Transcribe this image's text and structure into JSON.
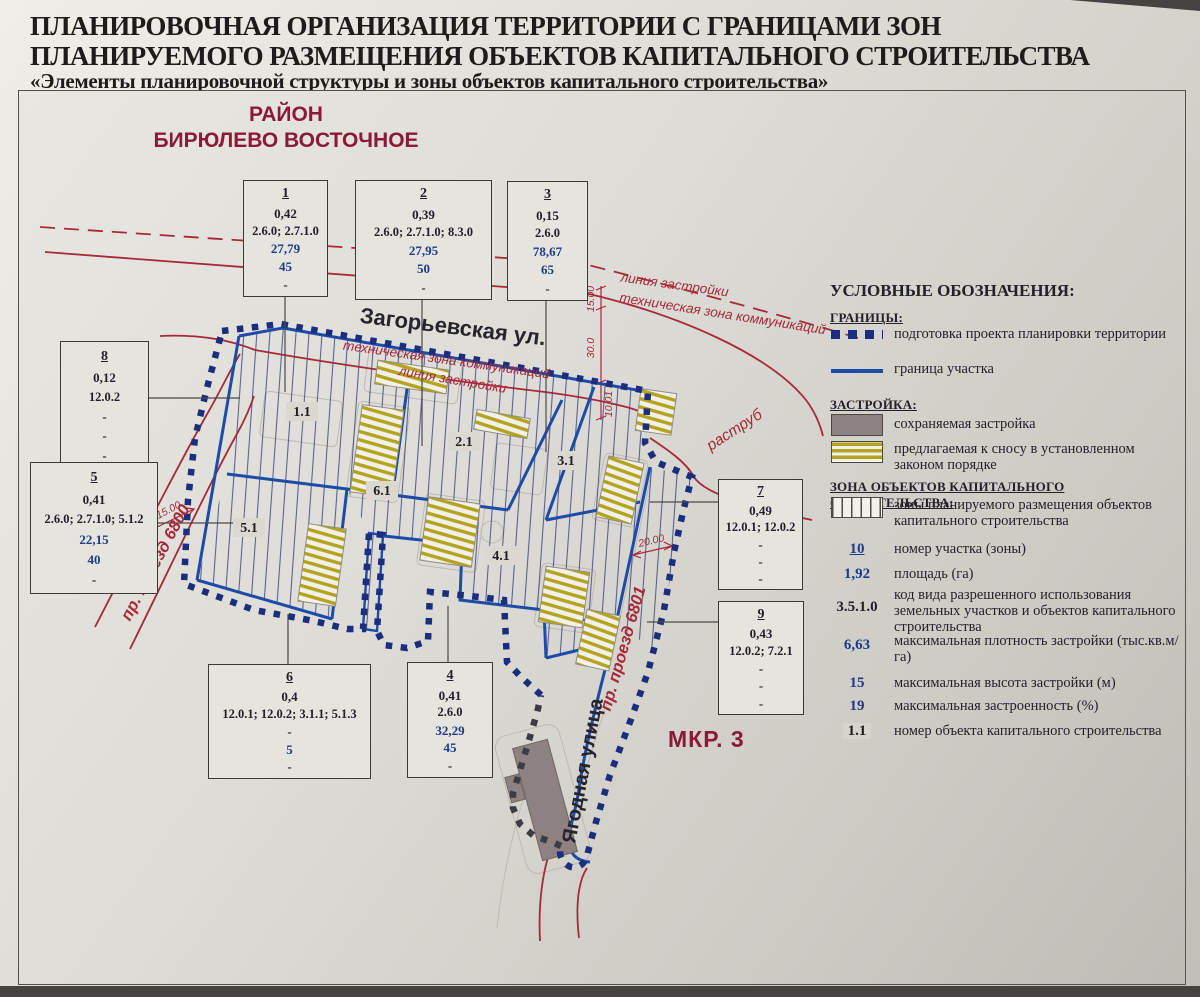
{
  "title": {
    "line1": "ПЛАНИРОВОЧНАЯ ОРГАНИЗАЦИЯ ТЕРРИТОРИИ С ГРАНИЦАМИ ЗОН",
    "line2": "ПЛАНИРУЕМОГО РАЗМЕЩЕНИЯ ОБЪЕКТОВ КАПИТАЛЬНОГО СТРОИТЕЛЬСТВА",
    "line3": "«Элементы планировочной структуры и зоны объектов капитального строительства»"
  },
  "region": {
    "line1": "РАЙОН",
    "line2": "БИРЮЛЕВО ВОСТОЧНОЕ"
  },
  "district_label": "МКР. 3",
  "streets": {
    "zagorevskaya": "Загорьевская ул.",
    "yagodnaya": "Ягодная улица",
    "proezd_6800": "пр. проезд 6800",
    "proezd_6801": "пр. проезд 6801"
  },
  "map_labels": {
    "liniya_zastroyki_right": "линия застройки",
    "tech_zona_right": "техническая зона коммуникаций",
    "tech_zona_inner": "техническая зона коммуникаций",
    "liniya_zastroyki_inner": "линия застройки",
    "rastrub": "раструб"
  },
  "dimensions": {
    "d15_top": "15.00",
    "d30": "30.0",
    "d10": "10.01",
    "d20": "20.00",
    "d15_left": "15.00"
  },
  "zone_labels": {
    "z1": "1.1",
    "z2": "2.1",
    "z3": "3.1",
    "z4": "4.1",
    "z5": "5.1",
    "z6": "6.1"
  },
  "boxes": {
    "b1": {
      "num": "1",
      "area": "0,42",
      "codes": "2.6.0; 2.7.1.0",
      "density": "27,79",
      "height": "45",
      "footnote": "-",
      "density_color": "#1d3a8c",
      "height_color": "#1d3a8c"
    },
    "b2": {
      "num": "2",
      "area": "0,39",
      "codes": "2.6.0; 2.7.1.0; 8.3.0",
      "density": "27,95",
      "height": "50",
      "footnote": "-",
      "density_color": "#1d3a8c",
      "height_color": "#1d3a8c"
    },
    "b3": {
      "num": "3",
      "area": "0,15",
      "codes": "2.6.0",
      "density": "78,67",
      "height": "65",
      "footnote": "-",
      "density_color": "#1d3a8c",
      "height_color": "#1d3a8c"
    },
    "b4": {
      "num": "4",
      "area": "0,41",
      "codes": "2.6.0",
      "density": "32,29",
      "height": "45",
      "footnote": "-",
      "density_color": "#1d3a8c",
      "height_color": "#1d3a8c"
    },
    "b5": {
      "num": "5",
      "area": "0,41",
      "codes": "2.6.0; 2.7.1.0; 5.1.2",
      "density": "22,15",
      "height": "40",
      "footnote": "-",
      "density_color": "#1d3a8c",
      "height_color": "#1d3a8c"
    },
    "b6": {
      "num": "6",
      "area": "0,4",
      "codes": "12.0.1; 12.0.2; 3.1.1; 5.1.3",
      "density": "-",
      "height": "5",
      "footnote": "-",
      "density_color": "#22212a",
      "height_color": "#1d3a8c"
    },
    "b7": {
      "num": "7",
      "area": "0,49",
      "codes": "12.0.1; 12.0.2",
      "density": "-",
      "height": "-",
      "footnote": "-",
      "density_color": "#22212a",
      "height_color": "#22212a"
    },
    "b8": {
      "num": "8",
      "area": "0,12",
      "codes": "12.0.2",
      "density": "-",
      "height": "-",
      "footnote": "-",
      "density_color": "#22212a",
      "height_color": "#22212a"
    },
    "b9": {
      "num": "9",
      "area": "0,43",
      "codes": "12.0.2; 7.2.1",
      "density": "-",
      "height": "-",
      "footnote": "-",
      "density_color": "#22212a",
      "height_color": "#22212a"
    }
  },
  "legend": {
    "title": "УСЛОВНЫЕ ОБОЗНАЧЕНИЯ:",
    "granitsy_heading": "ГРАНИЦЫ:",
    "item_ppt": "подготовка проекта планировки территории",
    "item_boundary": "граница участка",
    "zastroyka_heading": "ЗАСТРОЙКА:",
    "item_preserved": "сохраняемая застройка",
    "item_demolish": "предлагаемая к сносу в установленном законом порядке",
    "zona_heading": "ЗОНА ОБЪЕКТОВ КАПИТАЛЬНОГО СТРОИТЕЛЬСТВА:",
    "item_planned": "зоны планируемого размещения объектов капитального строительства",
    "num_sample": "10",
    "num_desc": "номер участка (зоны)",
    "area_sample": "1,92",
    "area_desc": "площадь (га)",
    "code_sample": "3.5.1.0",
    "code_desc": "код вида разрешенного использования земельных участков и объектов капитального строительства",
    "density_sample": "6,63",
    "density_desc": "максимальная плотность застройки (тыс.кв.м/га)",
    "height_sample": "15",
    "height_desc": "максимальная высота застройки (м)",
    "built_sample": "19",
    "built_desc": "максимальная застроенность (%)",
    "object_sample": "1.1",
    "object_desc": "номер объекта капитального строительства"
  },
  "colors": {
    "accent_red": "#a8293a",
    "dark_red": "#8c1a36",
    "boundary_navy": "#1b2d7d",
    "parcel_blue": "#1d4ba8",
    "value_blue": "#1d3a8c",
    "demolish_yellow": "#b3a31f",
    "preserved_gray": "#8d8182"
  }
}
